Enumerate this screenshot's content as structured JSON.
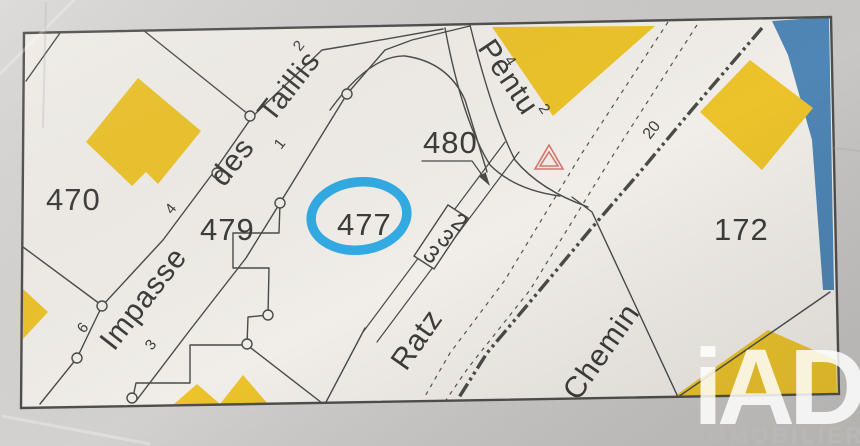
{
  "map": {
    "parcel_labels": {
      "p470": "470",
      "p479": "479",
      "p477": "477",
      "p480": "480",
      "p332_c1": "3",
      "p332_c2": "3",
      "p332_c3": "2",
      "p172": "172"
    },
    "street_labels": {
      "impasse": "Impasse",
      "des": "des",
      "taillis": "Taillis",
      "pentu": "Pentu",
      "ratz": "Ratz",
      "chemin": "Chemin"
    },
    "lot_numbers": {
      "taillis_2": "2",
      "taillis_1": "1",
      "taillis_4": "4",
      "impasse_6": "6",
      "impasse_3": "3",
      "pentu_4": "4",
      "pentu_2": "2",
      "ratz_20": "20"
    },
    "highlight": {
      "highlighted_parcel": "477",
      "color": "#27a7e4"
    },
    "icons": {
      "geodetic_marker": "red-double-triangle",
      "boundary_marker": "small-circle"
    }
  },
  "watermark": {
    "brand": "iAD",
    "word": "IMMOBILIER"
  },
  "colors": {
    "building": "#ecc32a",
    "line": "#4a4a48",
    "map_bg": "#f1eee9",
    "paper": "#cfcdcb",
    "water": "#4e86b5",
    "triangle_marker": "#d4776f"
  }
}
